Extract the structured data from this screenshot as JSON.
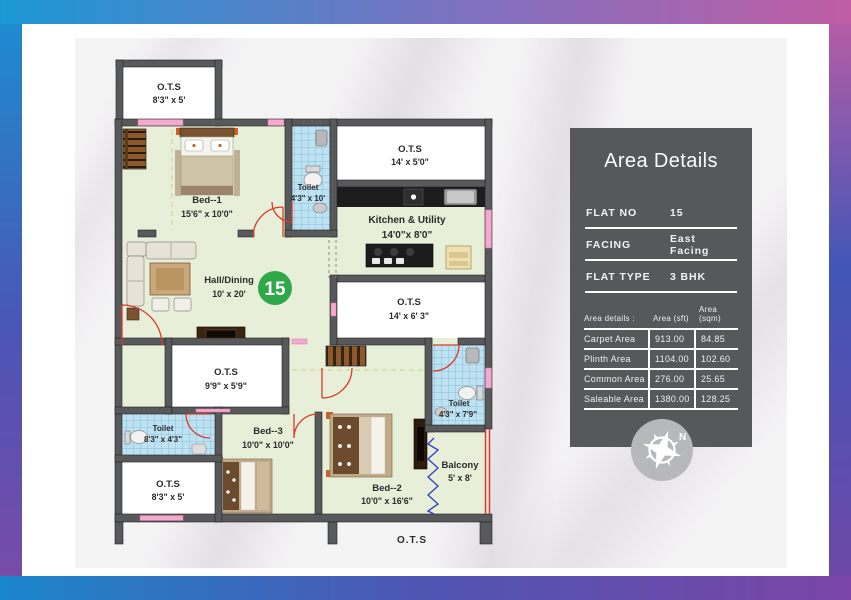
{
  "panel": {
    "title": "Area Details",
    "fields": [
      {
        "label": "FLAT NO",
        "value": "15"
      },
      {
        "label": "FACING",
        "value": "East Facing"
      },
      {
        "label": "FLAT TYPE",
        "value": "3 BHK"
      }
    ],
    "table": {
      "header": {
        "label": "Area details :",
        "sft": "Area (sft)",
        "sqm": "Area (sqm)"
      },
      "rows": [
        {
          "label": "Carpet Area",
          "sft": "913.00",
          "sqm": "84.85"
        },
        {
          "label": "Plinth Area",
          "sft": "1104.00",
          "sqm": "102.60"
        },
        {
          "label": "Common Area",
          "sft": "276.00",
          "sqm": "25.65"
        },
        {
          "label": "Saleable Area",
          "sft": "1380.00",
          "sqm": "128.25"
        }
      ]
    },
    "compass_letter": "N"
  },
  "plan": {
    "unit_badge": "15",
    "rooms": [
      {
        "name": "O.T.S",
        "dims": "8'3\" x 5'"
      },
      {
        "name": "Bed--1",
        "dims": "15'6\" x 10'0\""
      },
      {
        "name": "Toilet",
        "dims": "4'3\" x 10'"
      },
      {
        "name": "O.T.S",
        "dims": "14' x 5'0\""
      },
      {
        "name": "Kitchen & Utility",
        "dims": "14'0\"x 8'0\""
      },
      {
        "name": "Hall/Dining",
        "dims": "10' x 20'"
      },
      {
        "name": "O.T.S",
        "dims": "14' x 6' 3\""
      },
      {
        "name": "O.T.S",
        "dims": "9'9\" x 5'9\""
      },
      {
        "name": "Toilet",
        "dims": "8'3\" x 4'3\""
      },
      {
        "name": "Bed--3",
        "dims": "10'0\" x 10'0\""
      },
      {
        "name": "O.T.S",
        "dims": "8'3\" x 5'"
      },
      {
        "name": "Bed--2",
        "dims": "10'0\" x 16'6\""
      },
      {
        "name": "Toilet",
        "dims": "4'3\" x 7'9\""
      },
      {
        "name": "Balcony",
        "dims": "5' x 8'"
      },
      {
        "name": "O.T.S",
        "dims": ""
      }
    ]
  },
  "colors": {
    "panel_bg": "#57585a",
    "badge_green": "#2fa84a",
    "floor_green": "#e7efd9",
    "toilet_blue": "#bfe2f2",
    "wall_gray": "#58595b",
    "window_pink": "#f2aacd",
    "door_red": "#d93a2a",
    "counter_black": "#1d1d1d",
    "frame_blue": "#1b98d4",
    "frame_pink": "#c05da4",
    "frame_purple": "#7a45a6"
  }
}
